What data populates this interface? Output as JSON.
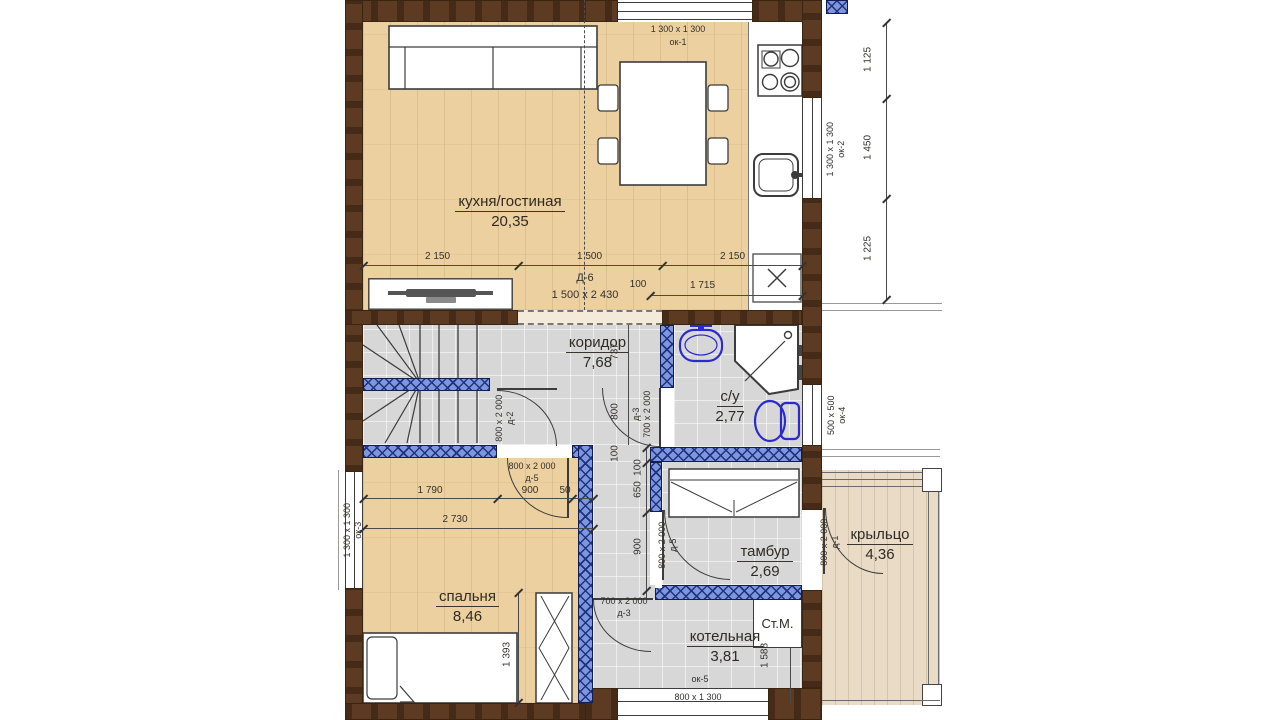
{
  "rooms": {
    "kitchen": {
      "name": "кухня/гостиная",
      "area": "20,35"
    },
    "corridor": {
      "name": "коридор",
      "area": "7,68"
    },
    "bathroom": {
      "name": "с/у",
      "area": "2,77"
    },
    "bedroom": {
      "name": "спальня",
      "area": "8,46"
    },
    "tambour": {
      "name": "тамбур",
      "area": "2,69"
    },
    "boiler": {
      "name": "котельная",
      "area": "3,81"
    },
    "porch": {
      "name": "крыльцо",
      "area": "4,36"
    }
  },
  "windows": {
    "ok1": {
      "size": "1 300 х 1 300",
      "code": "ок-1"
    },
    "ok2": {
      "size": "1 300 х 1 300",
      "code": "ок-2"
    },
    "ok3": {
      "size": "1 300 х 1 300",
      "code": "ок-3"
    },
    "ok4": {
      "size": "500 х 500",
      "code": "ок-4"
    },
    "ok5": {
      "size": "800 х 1 300",
      "code": "ок-5"
    }
  },
  "doors": {
    "d6": {
      "code": "Д-6",
      "size": "1 500 х 2 430"
    },
    "d1": {
      "code": "д-1",
      "size": "800 х 2 000"
    },
    "d2": {
      "code": "д-2",
      "size": "800 х 2 000"
    },
    "d3_bath": {
      "code": "д-3",
      "size": "700 х 2 000"
    },
    "d3_boiler": {
      "code": "д-3",
      "size": "700 х 2 000"
    },
    "d5_bedroom": {
      "code": "д-5",
      "size": "800 х 2 000"
    },
    "d5_tambour": {
      "code": "д-5",
      "size": "800 х 2 000"
    }
  },
  "dimensions": {
    "top_left": "2 150",
    "top_mid": "1 500",
    "top_right": "2 150",
    "top_small": "100",
    "top_inner": "1 715",
    "right_top": "1 125",
    "right_mid": "1 450",
    "right_bottom": "1 225",
    "corridor_737": "737",
    "corridor_800": "800",
    "corridor_100": "100",
    "bedroom_1790": "1 790",
    "bedroom_900": "900",
    "bedroom_50": "50",
    "bedroom_2730": "2 730",
    "bedroom_1393": "1 393",
    "tambour_100": "100",
    "tambour_650": "650",
    "tambour_900": "900",
    "boiler_1588": "1 588"
  },
  "appliances": {
    "washer": "Ст.М."
  },
  "colors": {
    "outer_wall": "#5d3b22",
    "partition_wall": "#7b97e0",
    "wood_floor": "#ecd0a0",
    "tile_floor": "#d7d7d7",
    "deck_floor": "#e9dbc6",
    "sanitary_blue": "#2a2ad0"
  }
}
